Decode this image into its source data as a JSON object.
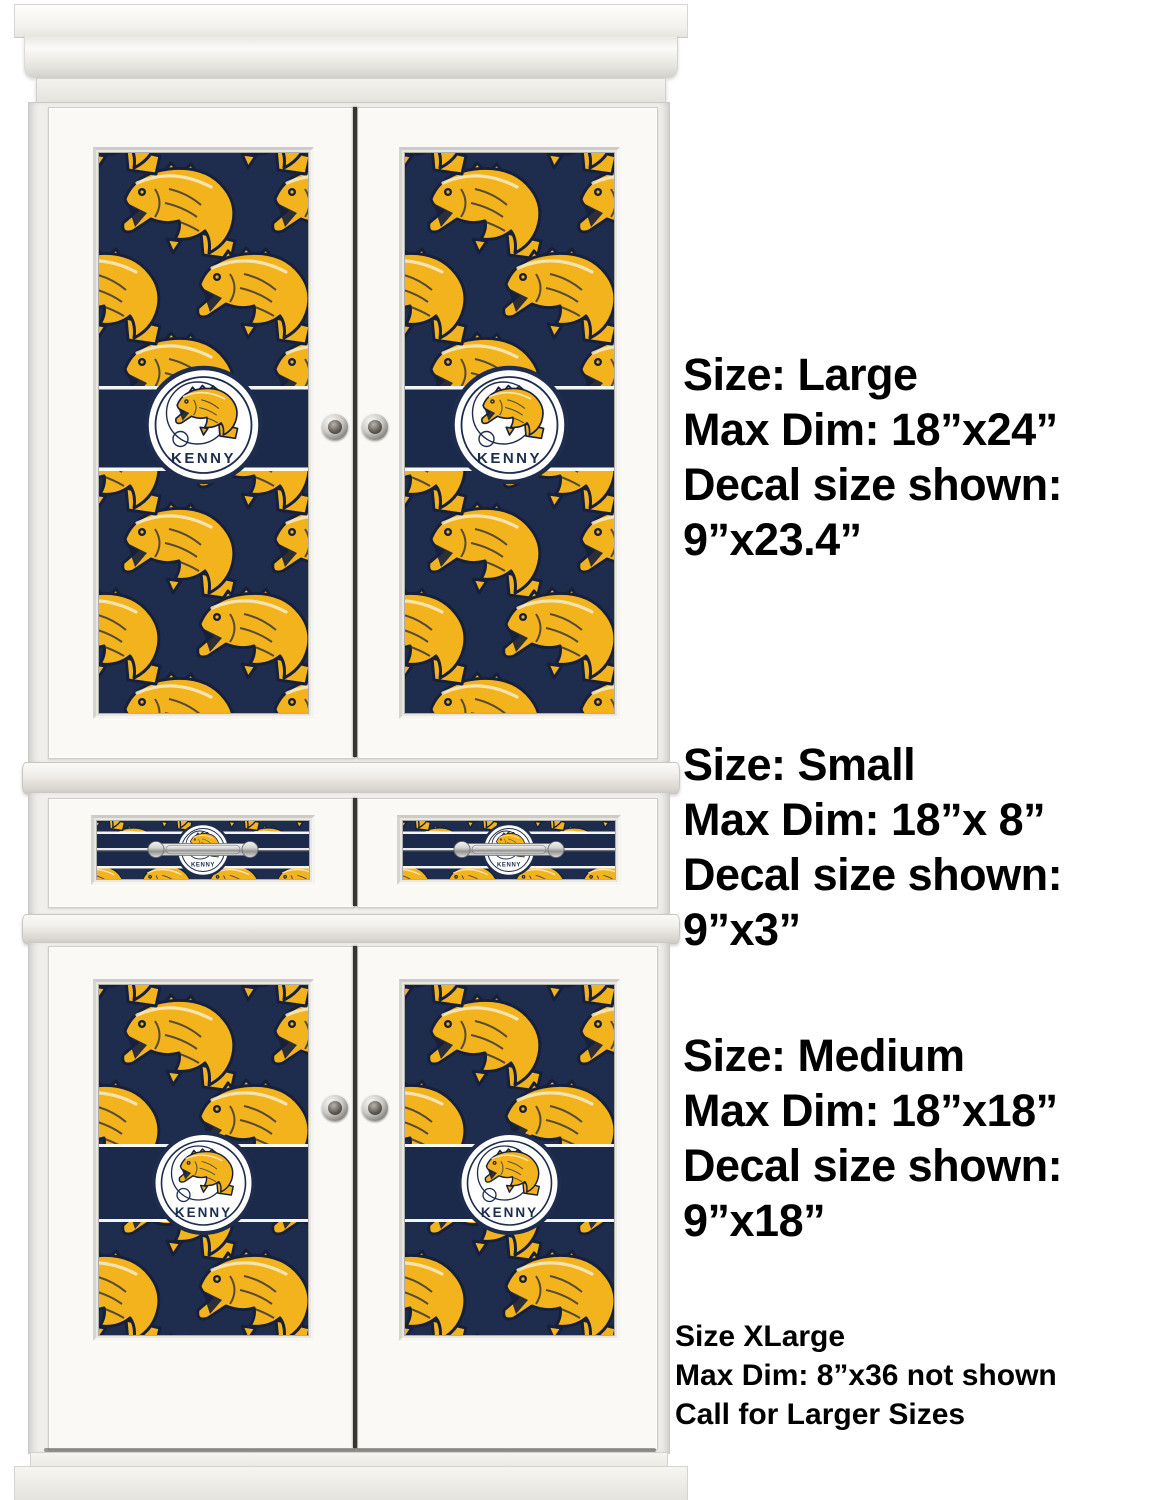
{
  "decal": {
    "name": "KENNY",
    "pattern": "fly-fishing-bass-repeat-pattern",
    "colors": {
      "navy": "#1e2c4e",
      "ink": "#16203c",
      "gold": "#f2b31d",
      "cream": "#f6ecca",
      "band": "#1b2a4a",
      "badge_white": "#ffffff"
    }
  },
  "size_blocks": [
    {
      "id": "large",
      "lines": [
        "Size: Large",
        "Max Dim: 18”x24”",
        "Decal size shown:",
        "9”x23.4”"
      ]
    },
    {
      "id": "small",
      "lines": [
        "Size: Small",
        "Max Dim: 18”x 8”",
        "Decal size shown:",
        "9”x3”"
      ]
    },
    {
      "id": "medium",
      "lines": [
        "Size: Medium",
        "Max Dim: 18”x18”",
        "Decal size shown:",
        "9”x18”"
      ]
    }
  ],
  "xlarge_note": {
    "lines": [
      "Size XLarge",
      "Max Dim: 8”x36 not shown",
      "Call for Larger Sizes"
    ]
  }
}
